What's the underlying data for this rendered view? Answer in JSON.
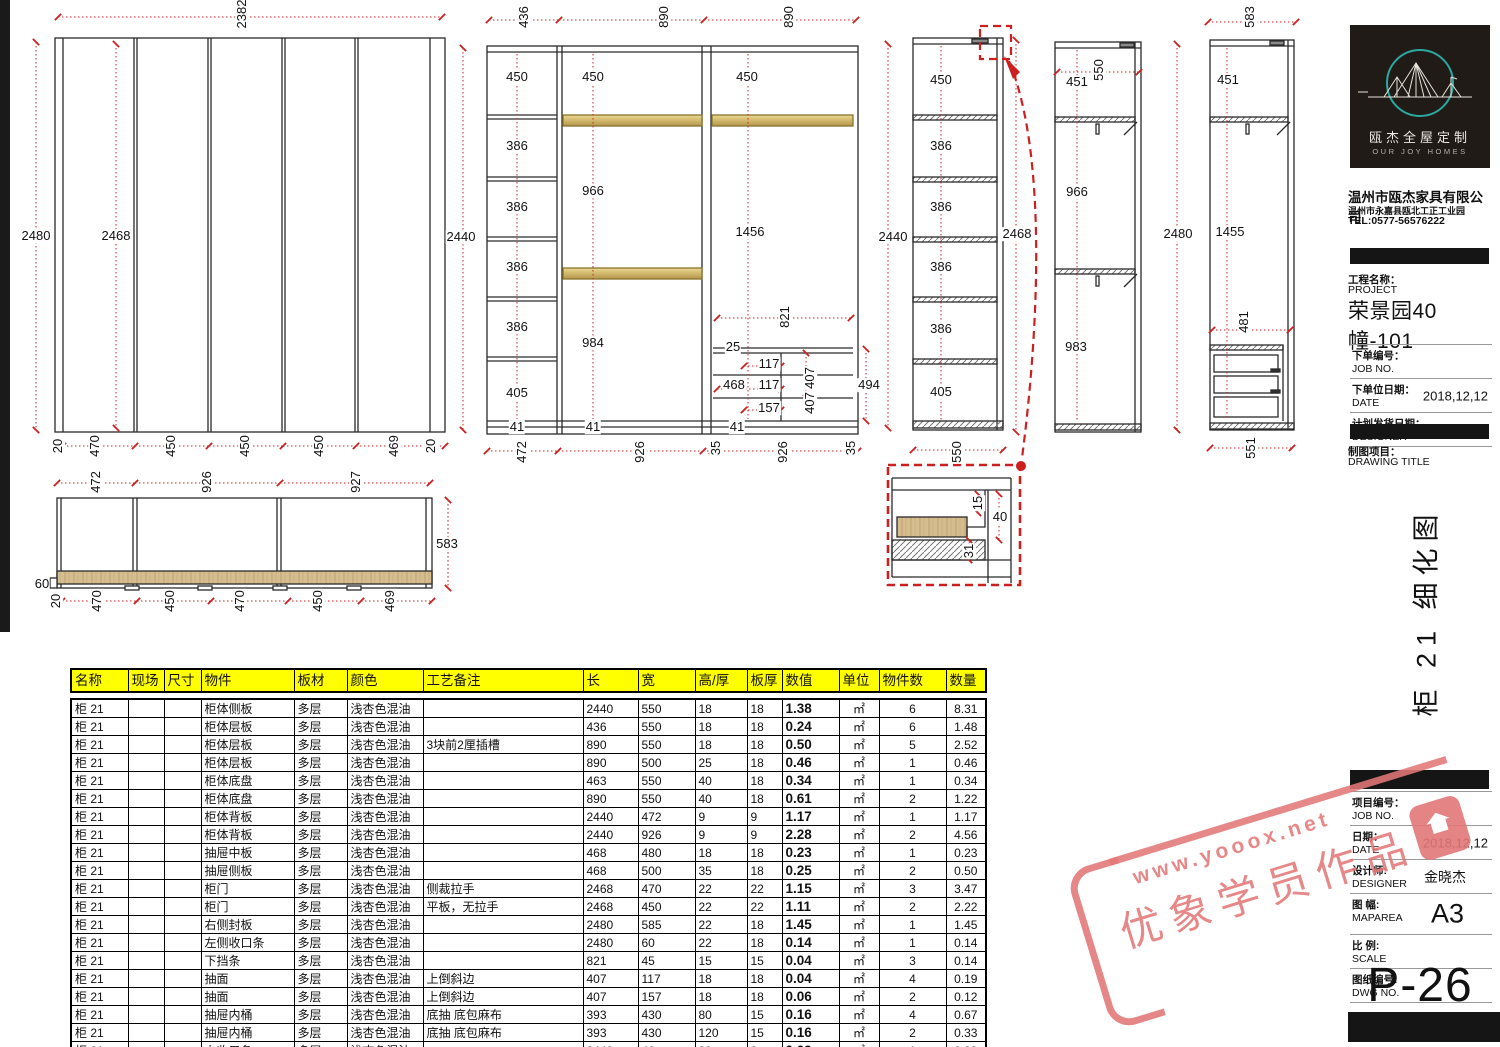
{
  "colors": {
    "dim_red": "#cc2020",
    "gold": "#d4b960",
    "wood": "#d6bd8f",
    "header_yellow": "#ffff00",
    "teal": "#2ba8a0"
  },
  "title_block": {
    "logo": {
      "brand_cn": "瓯杰全屋定制",
      "brand_en": "OUR JOY HOMES"
    },
    "company": "温州市瓯杰家具有限公司",
    "address": "温州市永嘉县瓯北工正工业园",
    "tel": "TEL:0577-56576222",
    "project_label_cn": "工程名称：",
    "project_label_en": "PROJECT",
    "project_name": "荣景园40幢-101",
    "fields_top": [
      {
        "cn": "下单编号：",
        "en": "JOB NO.",
        "value": ""
      },
      {
        "cn": "下单位日期：",
        "en": "DATE",
        "value": "2018,12,12"
      },
      {
        "cn": "计划发货日期：",
        "en": "DESIGNER",
        "value": "2018,12,25"
      }
    ],
    "drawing_title_label_cn": "制图项目：",
    "drawing_title_label_en": "DRAWING TITLE",
    "drawing_title_vertical": "柜 21 细化图",
    "fields_bottom": [
      {
        "cn": "项目编号：",
        "en": "JOB NO.",
        "value": ""
      },
      {
        "cn": "日期：",
        "en": "DATE",
        "value": "2018,12,12"
      },
      {
        "cn": "设计师:",
        "en": "DESIGNER",
        "value": "金晓杰"
      },
      {
        "cn": "图 幅:",
        "en": "MAPAREA",
        "value": "A3"
      },
      {
        "cn": "比 例:",
        "en": "SCALE",
        "value": ""
      },
      {
        "cn": "图纸编号:",
        "en": "DWG NO.",
        "value": ""
      }
    ],
    "page_no": "P-26"
  },
  "watermark": {
    "line1": "www.yooox.net",
    "line2": "优象学员作品"
  },
  "table": {
    "headers": [
      "名称",
      "现场",
      "尺寸",
      "物件",
      "板材",
      "颜色",
      "工艺备注",
      "长",
      "宽",
      "高/厚",
      "板厚",
      "数值",
      "单位",
      "物件数",
      "数量"
    ],
    "rows": [
      [
        "柜 21",
        "",
        "",
        "柜体侧板",
        "多层",
        "浅杏色混油",
        "",
        "2440",
        "550",
        "18",
        "18",
        "1.38",
        "㎡",
        "6",
        "8.31"
      ],
      [
        "柜 21",
        "",
        "",
        "柜体层板",
        "多层",
        "浅杏色混油",
        "",
        "436",
        "550",
        "18",
        "18",
        "0.24",
        "㎡",
        "6",
        "1.48"
      ],
      [
        "柜 21",
        "",
        "",
        "柜体层板",
        "多层",
        "浅杏色混油",
        "3块前2厘插槽",
        "890",
        "550",
        "18",
        "18",
        "0.50",
        "㎡",
        "5",
        "2.52"
      ],
      [
        "柜 21",
        "",
        "",
        "柜体层板",
        "多层",
        "浅杏色混油",
        "",
        "890",
        "500",
        "25",
        "18",
        "0.46",
        "㎡",
        "1",
        "0.46"
      ],
      [
        "柜 21",
        "",
        "",
        "柜体底盘",
        "多层",
        "浅杏色混油",
        "",
        "463",
        "550",
        "40",
        "18",
        "0.34",
        "㎡",
        "1",
        "0.34"
      ],
      [
        "柜 21",
        "",
        "",
        "柜体底盘",
        "多层",
        "浅杏色混油",
        "",
        "890",
        "550",
        "40",
        "18",
        "0.61",
        "㎡",
        "2",
        "1.22"
      ],
      [
        "柜 21",
        "",
        "",
        "柜体背板",
        "多层",
        "浅杏色混油",
        "",
        "2440",
        "472",
        "9",
        "9",
        "1.17",
        "㎡",
        "1",
        "1.17"
      ],
      [
        "柜 21",
        "",
        "",
        "柜体背板",
        "多层",
        "浅杏色混油",
        "",
        "2440",
        "926",
        "9",
        "9",
        "2.28",
        "㎡",
        "2",
        "4.56"
      ],
      [
        "柜 21",
        "",
        "",
        "抽屉中板",
        "多层",
        "浅杏色混油",
        "",
        "468",
        "480",
        "18",
        "18",
        "0.23",
        "㎡",
        "1",
        "0.23"
      ],
      [
        "柜 21",
        "",
        "",
        "抽屉侧板",
        "多层",
        "浅杏色混油",
        "",
        "468",
        "500",
        "35",
        "18",
        "0.25",
        "㎡",
        "2",
        "0.50"
      ],
      [
        "柜 21",
        "",
        "",
        "柜门",
        "多层",
        "浅杏色混油",
        "侧裁拉手",
        "2468",
        "470",
        "22",
        "22",
        "1.15",
        "㎡",
        "3",
        "3.47"
      ],
      [
        "柜 21",
        "",
        "",
        "柜门",
        "多层",
        "浅杏色混油",
        "平板，无拉手",
        "2468",
        "450",
        "22",
        "22",
        "1.11",
        "㎡",
        "2",
        "2.22"
      ],
      [
        "柜 21",
        "",
        "",
        "右侧封板",
        "多层",
        "浅杏色混油",
        "",
        "2480",
        "585",
        "22",
        "18",
        "1.45",
        "㎡",
        "1",
        "1.45"
      ],
      [
        "柜 21",
        "",
        "",
        "左侧收口条",
        "多层",
        "浅杏色混油",
        "",
        "2480",
        "60",
        "22",
        "18",
        "0.14",
        "㎡",
        "1",
        "0.14"
      ],
      [
        "柜 21",
        "",
        "",
        "下挡条",
        "多层",
        "浅杏色混油",
        "",
        "821",
        "45",
        "15",
        "15",
        "0.04",
        "㎡",
        "3",
        "0.14"
      ],
      [
        "柜 21",
        "",
        "",
        "抽面",
        "多层",
        "浅杏色混油",
        "上倒斜边",
        "407",
        "117",
        "18",
        "18",
        "0.04",
        "㎡",
        "4",
        "0.19"
      ],
      [
        "柜 21",
        "",
        "",
        "抽面",
        "多层",
        "浅杏色混油",
        "上倒斜边",
        "407",
        "157",
        "18",
        "18",
        "0.06",
        "㎡",
        "2",
        "0.12"
      ],
      [
        "柜 21",
        "",
        "",
        "抽屉内桶",
        "多层",
        "浅杏色混油",
        "底抽 底包麻布",
        "393",
        "430",
        "80",
        "15",
        "0.16",
        "㎡",
        "4",
        "0.67"
      ],
      [
        "柜 21",
        "",
        "",
        "抽屉内桶",
        "多层",
        "浅杏色混油",
        "底抽 底包麻布",
        "393",
        "430",
        "120",
        "15",
        "0.16",
        "㎡",
        "2",
        "0.33"
      ],
      [
        "柜 21",
        "",
        "",
        "上收口条",
        "多层",
        "浅杏色混油",
        "",
        "2440",
        "40",
        "30",
        "2",
        "0.09",
        "㎡",
        "1",
        "0.09"
      ]
    ]
  },
  "dims": [
    [
      "2382",
      242,
      14,
      1
    ],
    [
      "2480",
      36,
      236,
      0
    ],
    [
      "2468",
      116,
      236,
      0
    ],
    [
      "20",
      58,
      446,
      1
    ],
    [
      "470",
      95,
      446,
      1
    ],
    [
      "450",
      171,
      446,
      1
    ],
    [
      "450",
      245,
      446,
      1
    ],
    [
      "450",
      319,
      446,
      1
    ],
    [
      "469",
      394,
      446,
      1
    ],
    [
      "20",
      431,
      446,
      1
    ],
    [
      "436",
      524,
      17,
      1
    ],
    [
      "890",
      664,
      17,
      1
    ],
    [
      "890",
      789,
      17,
      1
    ],
    [
      "2440",
      461,
      237,
      0
    ],
    [
      "450",
      517,
      77,
      0
    ],
    [
      "386",
      517,
      146,
      0
    ],
    [
      "386",
      517,
      207,
      0
    ],
    [
      "386",
      517,
      267,
      0
    ],
    [
      "386",
      517,
      327,
      0
    ],
    [
      "405",
      517,
      393,
      0
    ],
    [
      "41",
      517,
      427,
      0
    ],
    [
      "450",
      593,
      77,
      0
    ],
    [
      "966",
      593,
      191,
      0
    ],
    [
      "984",
      593,
      343,
      0
    ],
    [
      "41",
      593,
      427,
      0
    ],
    [
      "450",
      747,
      77,
      0
    ],
    [
      "1456",
      750,
      232,
      0
    ],
    [
      "821",
      785,
      317,
      1
    ],
    [
      "25",
      733,
      347,
      0
    ],
    [
      "117",
      769,
      364,
      0
    ],
    [
      "468",
      734,
      385,
      0
    ],
    [
      "117",
      769,
      385,
      0
    ],
    [
      "157",
      769,
      408,
      0
    ],
    [
      "41",
      737,
      427,
      0
    ],
    [
      "407",
      810,
      378,
      1
    ],
    [
      "407",
      810,
      403,
      1
    ],
    [
      "494",
      869,
      385,
      0
    ],
    [
      "472",
      522,
      452,
      1
    ],
    [
      "926",
      640,
      452,
      1
    ],
    [
      "35",
      716,
      448,
      1
    ],
    [
      "926",
      783,
      452,
      1
    ],
    [
      "35",
      851,
      448,
      1
    ],
    [
      "2440",
      893,
      237,
      0
    ],
    [
      "450",
      941,
      80,
      0
    ],
    [
      "386",
      941,
      146,
      0
    ],
    [
      "386",
      941,
      207,
      0
    ],
    [
      "386",
      941,
      267,
      0
    ],
    [
      "386",
      941,
      329,
      0
    ],
    [
      "405",
      941,
      392,
      0
    ],
    [
      "2468",
      1017,
      234,
      0
    ],
    [
      "550",
      957,
      452,
      1
    ],
    [
      "550",
      1099,
      70,
      1
    ],
    [
      "451",
      1077,
      82,
      0
    ],
    [
      "966",
      1077,
      192,
      0
    ],
    [
      "983",
      1076,
      347,
      0
    ],
    [
      "2480",
      1178,
      234,
      0
    ],
    [
      "583",
      1250,
      17,
      1
    ],
    [
      "451",
      1228,
      80,
      0
    ],
    [
      "1455",
      1230,
      232,
      0
    ],
    [
      "481",
      1244,
      322,
      1
    ],
    [
      "551",
      1251,
      448,
      1
    ],
    [
      "472",
      96,
      482,
      1
    ],
    [
      "926",
      207,
      482,
      1
    ],
    [
      "927",
      356,
      482,
      1
    ],
    [
      "583",
      447,
      544,
      0
    ],
    [
      "60",
      42,
      584,
      0
    ],
    [
      "20",
      56,
      601,
      1
    ],
    [
      "470",
      97,
      601,
      1
    ],
    [
      "450",
      170,
      601,
      1
    ],
    [
      "470",
      240,
      601,
      1
    ],
    [
      "450",
      318,
      601,
      1
    ],
    [
      "469",
      390,
      601,
      1
    ],
    [
      "15",
      978,
      503,
      1
    ],
    [
      "40",
      1000,
      517,
      0
    ],
    [
      "31",
      969,
      551,
      1
    ]
  ]
}
